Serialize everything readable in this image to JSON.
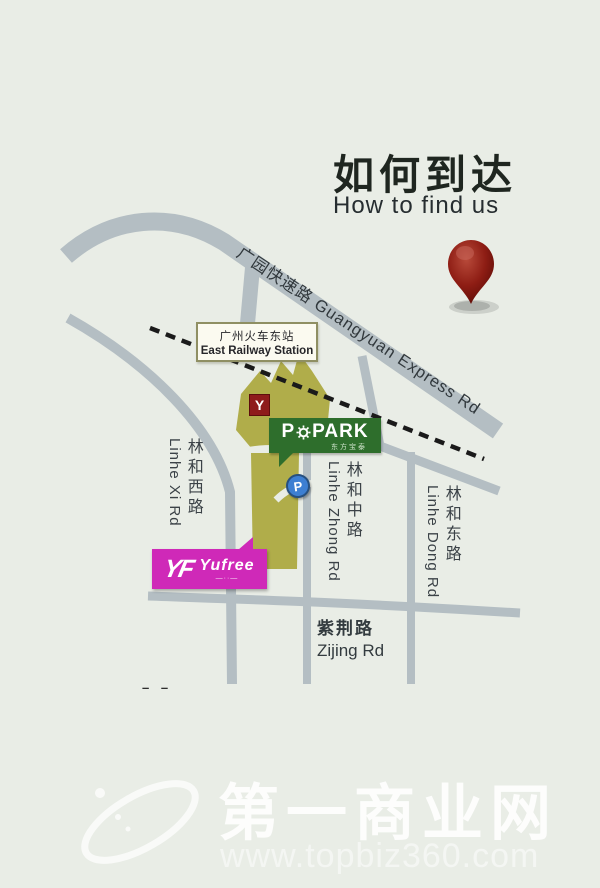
{
  "title": {
    "cn": "如何到达",
    "en": "How to find us"
  },
  "map": {
    "station": {
      "cn": "广州火车东站",
      "en": "East Railway Station"
    },
    "roads": {
      "guangyuan": {
        "cn": "广园快速路",
        "en": "Guangyuan Express Rd",
        "label": "广园快速路 Guangyuan Express Rd"
      },
      "linhe_xi": {
        "cn": "林和西路",
        "en": "Linhe Xi Rd"
      },
      "linhe_zhong": {
        "cn": "林和中路",
        "en": "Linhe Zhong Rd"
      },
      "linhe_dong": {
        "cn": "林和东路",
        "en": "Linhe Dong Rd"
      },
      "zijing": {
        "cn": "紫荆路",
        "en": "Zijing Rd"
      }
    },
    "popark": {
      "p": "P",
      "park": "PARK",
      "cn": "东方宝泰"
    },
    "yufree": {
      "mark": "YF",
      "name": "Yufree",
      "tagline": "—··—"
    },
    "parking_badge": "P",
    "y_badge": "Y",
    "edge_marks": "– –"
  },
  "watermark": {
    "site_cn": "第一商业网",
    "site_url": "www.topbiz360.com"
  },
  "colors": {
    "background": "#e9ede6",
    "road": "#b4bec3",
    "building": "#b0ad4a",
    "railway": "#1a1a1a",
    "popark_green": "#2e6e2c",
    "yufree_magenta": "#cf29b8",
    "parking_blue": "#3d7fd2",
    "badge_red": "#8e1b1b",
    "pin_red": "#8e1d14"
  }
}
